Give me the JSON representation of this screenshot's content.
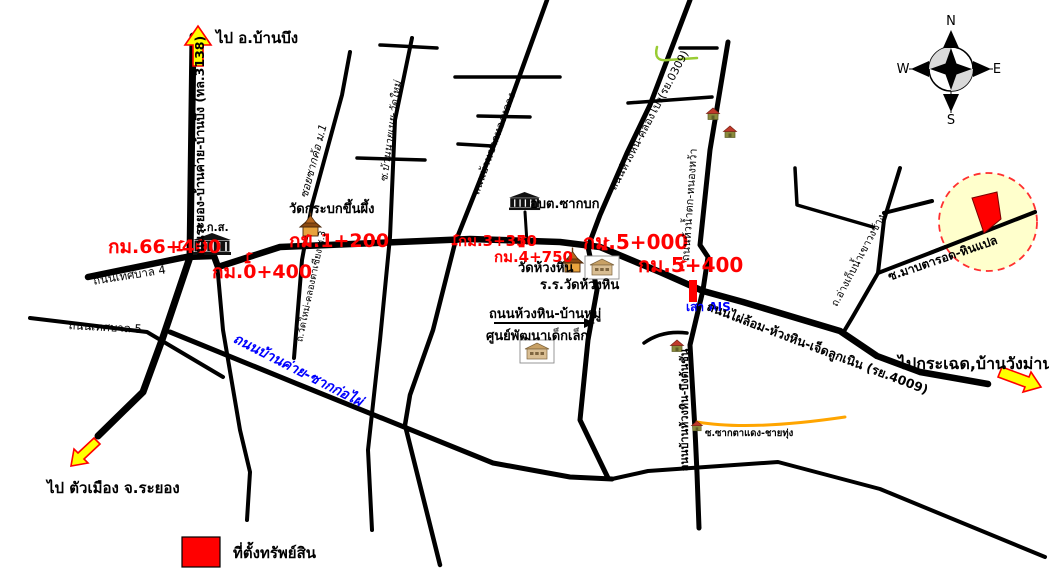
{
  "legend": {
    "label": "ที่ตั้งทรัพย์สิน"
  },
  "compass": {
    "north": "N",
    "south": "S",
    "east": "E",
    "west": "W"
  },
  "destinations": {
    "north": "ไป อ.บ้านบึง",
    "southwest": "ไป ตัวเมือง จ.ระยอง",
    "east": "ไปกระเฉด,บ้านวังม่าน"
  },
  "km_markers": {
    "km66_400": "กม.66+400",
    "km0_400": "กม.0+400",
    "km1_200": "กม.1+200",
    "km3_350": "กม.3+350",
    "km4_750": "กม.4+750",
    "km5_000": "กม.5+000",
    "km5_400": "กม.5+400"
  },
  "roads": {
    "rayong_bankhai_banbueng": "ถนนระยอง-บ้านค่าย-บ้านบึง (ทล.3138)",
    "soi_sakkho": "ซอยซากค้อ ม.1",
    "soi_ban_nai_noei_wat_mai": "ซ.บ้านนายเนย-วัดใหม่",
    "ban_sak_thonglang": "ถนนบ้านซากทองหลาง",
    "huanghin_khlongpong": "ถนนห้วงหิน-คลองโปง(รย.0309)",
    "huai_namtok_nongwa": "ถนนห้วน้ำตก-หนองหว้า",
    "ang_kep_nam_khao_wong_chang": "ถ.อ่างเก็บน้ำเขาวงช้าง",
    "soi_maptarot_hinplae": "ซ.มาบตารอด-หินแปล",
    "thetsaban_4": "ถนนเทศบาล 4",
    "thetsaban_5": "ถนนเทศบาล 5",
    "bankhai_sakkophai": "ถนนบ้านค่าย-ซากก่อไผ่",
    "wat_mai_khlong_ta_chiang": "ถ.วัดใหม่-คลองตาเชียง ซ.3",
    "phailom_huanghin_chetluknoen": "ถนนไผ่ล้อม-ห้วงหิน-เจ็ดลูกเนิน (รย.4009)",
    "huanghin_banmu": "ถนนห้วงหิน-บ้านหมู่",
    "soi_saktadaeng_chaithung": "ซ.ซากตาแดง-ชายทุ่ง",
    "ban_huanghin_buengtonchan": "ถนนบ้านห้วงหิน-บึงต้นชัน"
  },
  "places": {
    "baac_bank": "ธ.ก.ส.",
    "obt_sakbok": "อบต.ซากบก",
    "wat_krabok_khuen_phueng": "วัดกระบกขึ้นผึ้ง",
    "wat_huanghin": "วัดห้วงหิน",
    "school_wat_huanghin": "ร.ร.วัดห้วงหิน",
    "child_dev_center": "ศูนย์พัฒนาเด็กเล็ก",
    "ais_tower": "เสา AIS"
  },
  "colors": {
    "road": "#000000",
    "km_text": "#FF0000",
    "blue_label": "#0000FF",
    "orange_road": "#FFA500",
    "stream_green": "#99CC33",
    "arrow_fill": "#FFFF00",
    "arrow_stroke": "#FF0000",
    "property_fill": "#FF0000",
    "site_circle_fill": "#FFFFCC",
    "site_circle_stroke": "#FF3030"
  }
}
